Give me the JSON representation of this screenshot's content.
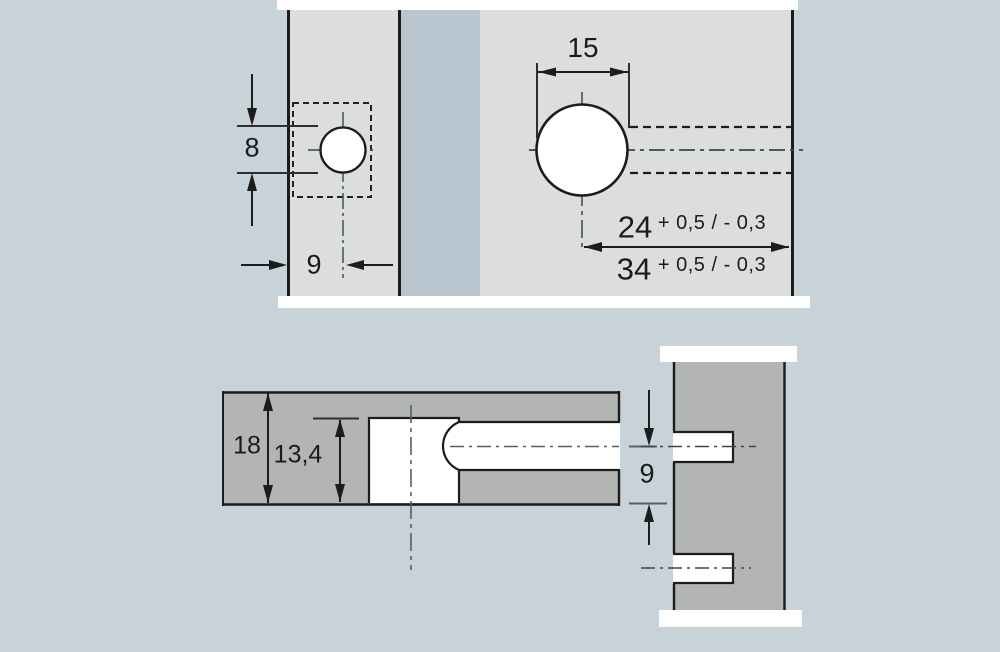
{
  "drawing": {
    "description": "Technical drawing: drilling pattern for furniture cabinet connector (two panels)",
    "edge_view": {
      "hole_diameter_dim": "8",
      "edge_offset_dim": "9"
    },
    "face_view": {
      "hole_width_dim": "15",
      "center_distance_dim": "24",
      "center_distance_tol": "+ 0,5 / - 0,3",
      "drill_depth_dim": "34",
      "drill_depth_tol": "+ 0,5 / - 0,3"
    },
    "section_view": {
      "panel_thickness_dim": "18",
      "housing_depth_dim": "13,4"
    },
    "side_panel_view": {
      "dowel_offset_dim": "9"
    },
    "colors": {
      "background": "#c7d2d9",
      "gap_band": "#b9c6cf",
      "panel_light": "#dcdedd",
      "panel_dark": "#b2b5b4",
      "hole_white": "#ffffff",
      "outline": "#1c1c1c",
      "centerline": "#4a5a64"
    }
  }
}
